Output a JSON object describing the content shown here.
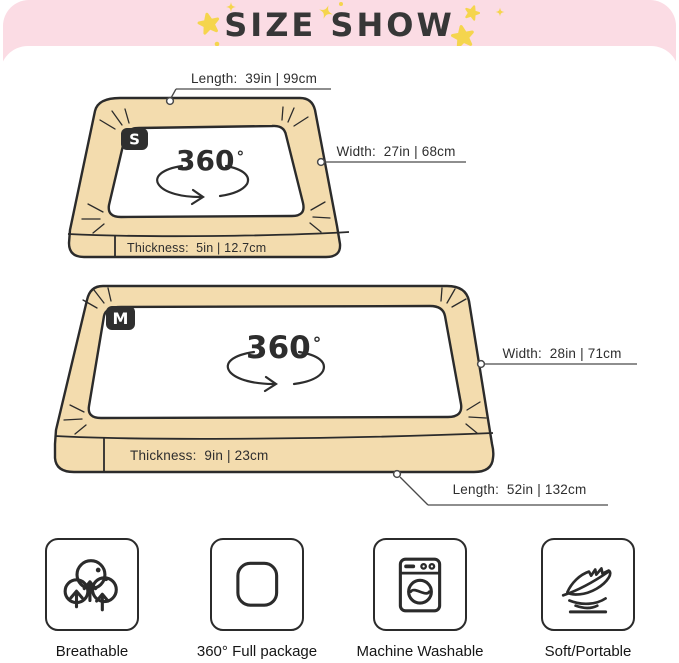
{
  "header": {
    "title": "SIZE SHOW",
    "background_color": "#fbdce4",
    "star_color": "#f5d54d",
    "title_color": "#373737"
  },
  "colors": {
    "mattress_fill": "#f3dcae",
    "outline": "#2b2b2b",
    "leader_line": "#4a4a4a",
    "card_background": "#ffffff"
  },
  "mattresses": [
    {
      "id": "small",
      "badge": "S",
      "rotate_label": "360",
      "degree_symbol": "°",
      "labels": {
        "length": "Length:  39in | 99cm",
        "width": "Width:  27in | 68cm",
        "thickness": "Thickness:  5in | 12.7cm"
      }
    },
    {
      "id": "medium",
      "badge": "M",
      "rotate_label": "360",
      "degree_symbol": "°",
      "labels": {
        "length": "Length:  52in | 132cm",
        "width": "Width:  28in | 71cm",
        "thickness": "Thickness:  9in | 23cm"
      }
    }
  ],
  "features": [
    {
      "label": "Breathable",
      "icon": "breathable-icon"
    },
    {
      "label": "360° Full package",
      "icon": "full-package-icon"
    },
    {
      "label": "Machine Washable",
      "icon": "machine-washable-icon"
    },
    {
      "label": "Soft/Portable",
      "icon": "feather-icon"
    }
  ]
}
